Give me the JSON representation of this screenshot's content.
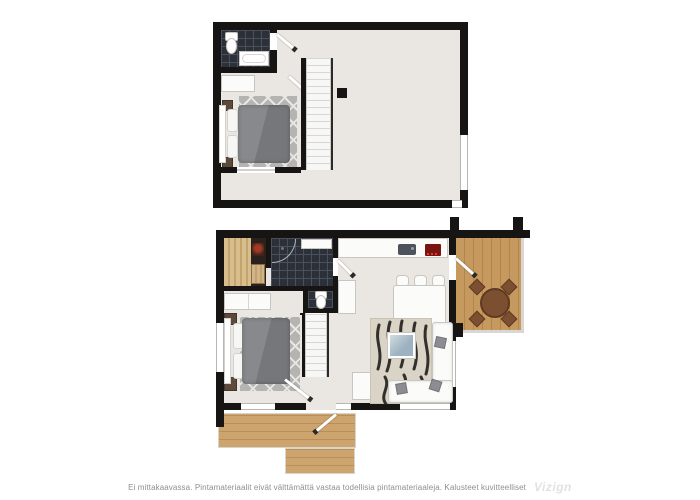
{
  "disclaimer": {
    "text": "Ei mittakaavassa. Pintamateriaalit eivät välttämättä vastaa todellisia pintamateriaaleja. Kalusteet kuvitteelliset",
    "watermark": "Vizign"
  },
  "floors": [
    {
      "id": "upper-floor",
      "features": [
        "bathroom",
        "toilet",
        "bathtub",
        "bedroom",
        "double-bed",
        "diamond-rug",
        "dresser",
        "nightstands",
        "staircase",
        "stair-railing",
        "column",
        "open-loft",
        "right-wall-window",
        "interior-doors"
      ]
    },
    {
      "id": "lower-floor",
      "features": [
        "sauna",
        "sauna-heater",
        "bathroom",
        "shower",
        "wc-toilet-room",
        "laundry-cabinets",
        "bedroom",
        "double-bed",
        "diamond-rug",
        "nightstands",
        "staircase",
        "kitchen-counter",
        "sink",
        "stove",
        "refrigerator",
        "dining-table",
        "six-dining-chairs",
        "living-room",
        "corner-sofa",
        "sofa-pillows",
        "glass-coffee-table",
        "patterned-area-rug",
        "desk",
        "balcony-deck",
        "round-outdoor-table",
        "four-outdoor-chairs",
        "entrance-terrace-deck",
        "windows",
        "doors"
      ]
    }
  ],
  "colors": {
    "bg": "#ffffff",
    "wall": "#161513",
    "floor": "#eae7e2",
    "tile_dark": "#2c3038",
    "tile_grid": "#4a505c",
    "sauna_wood": "#d8bd8d",
    "sauna_wood_dark": "#c3a46d",
    "sauna_dark": "#2a211c",
    "stove_heater": "#42241b",
    "deck_wood": "#c69a5f",
    "deck_stripe": "#b1854d",
    "terrace_wood": "#cda46e",
    "terrace_stripe": "#b98f59",
    "furn_white": "#fbfbfa",
    "furn_border": "#c9c6c1",
    "bed_duvet": "#87898d",
    "bed_duvet_dark": "#75777b",
    "pillow": "#f6f6f4",
    "rug_gray": "#b6b4b1",
    "rug_lattice": "#e9e7e4",
    "rug_living": "#d9d4c5",
    "rug_stripe": "#201e1c",
    "coffee_table": "#9db2c0",
    "outdoor_brown": "#7c4f31",
    "outdoor_brown_dark": "#5e3a22",
    "nightstand": "#5d4a3c",
    "stairs": "#f7f7f6",
    "stair_line": "#d8d6d3",
    "railing": "#d9d7d3",
    "railing_dark": "#2a2a2a",
    "sink": "#4d525b",
    "stove_red": "#7a1410",
    "window_frame": "#b9b7b3",
    "text_gray": "#8f8f8f",
    "watermark": "#e2e2e2"
  }
}
